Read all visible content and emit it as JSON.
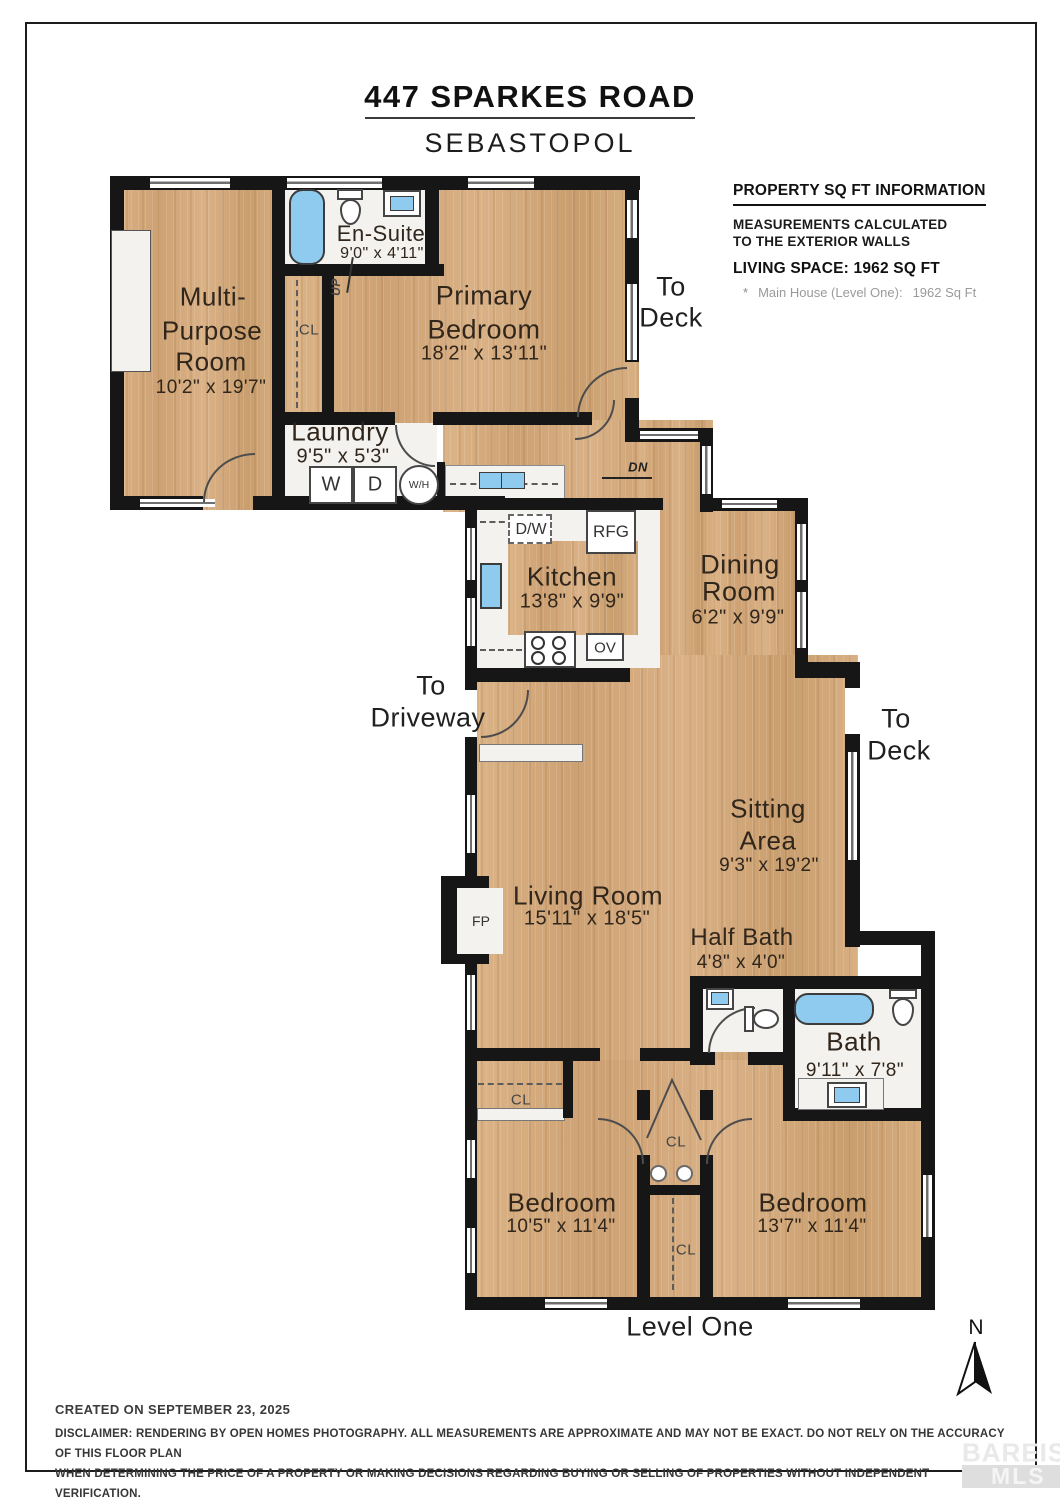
{
  "title": "447 SPARKES ROAD",
  "subtitle": "SEBASTOPOL",
  "info_panel": {
    "heading": "PROPERTY SQ FT INFORMATION",
    "measurements_line1": "MEASUREMENTS CALCULATED",
    "measurements_line2": "TO THE EXTERIOR WALLS",
    "living_space": "LIVING SPACE: 1962 SQ FT",
    "footnote_marker": "*",
    "footnote_label": "Main House (Level One):",
    "footnote_value": "1962 Sq Ft"
  },
  "rooms": {
    "multi_purpose": {
      "line1": "Multi-",
      "line2": "Purpose",
      "line3": "Room",
      "dims": "10'2\" x 19'7\""
    },
    "en_suite": {
      "name": "En-Suite",
      "dims": "9'0\" x 4'11\""
    },
    "primary_bedroom": {
      "line1": "Primary",
      "line2": "Bedroom",
      "dims": "18'2\" x 13'11\""
    },
    "laundry": {
      "name": "Laundry",
      "dims": "9'5\" x 5'3\""
    },
    "kitchen": {
      "name": "Kitchen",
      "dims": "13'8\" x 9'9\""
    },
    "dining_room": {
      "line1": "Dining",
      "line2": "Room",
      "dims": "6'2\" x 9'9\""
    },
    "living_room": {
      "name": "Living Room",
      "dims": "15'11\" x 18'5\""
    },
    "sitting_area": {
      "line1": "Sitting",
      "line2": "Area",
      "dims": "9'3\" x 19'2\""
    },
    "half_bath": {
      "name": "Half Bath",
      "dims": "4'8\" x 4'0\""
    },
    "bath": {
      "name": "Bath",
      "dims": "9'11\" x 7'8\""
    },
    "bedroom_left": {
      "name": "Bedroom",
      "dims": "10'5\" x 11'4\""
    },
    "bedroom_right": {
      "name": "Bedroom",
      "dims": "13'7\" x 11'4\""
    }
  },
  "exits": {
    "to_deck_top": {
      "line1": "To",
      "line2": "Deck"
    },
    "to_driveway": {
      "line1": "To",
      "line2": "Driveway"
    },
    "to_deck_right": {
      "line1": "To",
      "line2": "Deck"
    }
  },
  "fixtures": {
    "washer": "W",
    "dryer": "D",
    "water_heater": "W/H",
    "dishwasher": "D/W",
    "refrigerator": "RFG",
    "oven": "OV",
    "fireplace": "FP",
    "closet": "CL",
    "stairs_up": "UP",
    "stairs_down": "DN"
  },
  "level_label": "Level One",
  "compass": {
    "north_label": "N"
  },
  "footer": {
    "created": "CREATED ON SEPTEMBER 23, 2025",
    "disclaimer_line1": "DISCLAIMER: RENDERING BY OPEN HOMES PHOTOGRAPHY. ALL MEASUREMENTS ARE APPROXIMATE AND MAY NOT BE EXACT. DO NOT RELY ON THE ACCURACY OF THIS FLOOR PLAN",
    "disclaimer_line2": "WHEN DETERMINING THE PRICE OF A PROPERTY OR MAKING DECISIONS REGARDING BUYING OR SELLING OF PROPERTIES WITHOUT INDEPENDENT VERIFICATION."
  },
  "watermark": {
    "line1": "BAREIS",
    "reg": "®",
    "line2": "MLS"
  },
  "colors": {
    "wood": "#d7ad7d",
    "wall": "#161616",
    "fixture_blue": "#8fcbee",
    "room_white": "#f3f2ef"
  }
}
